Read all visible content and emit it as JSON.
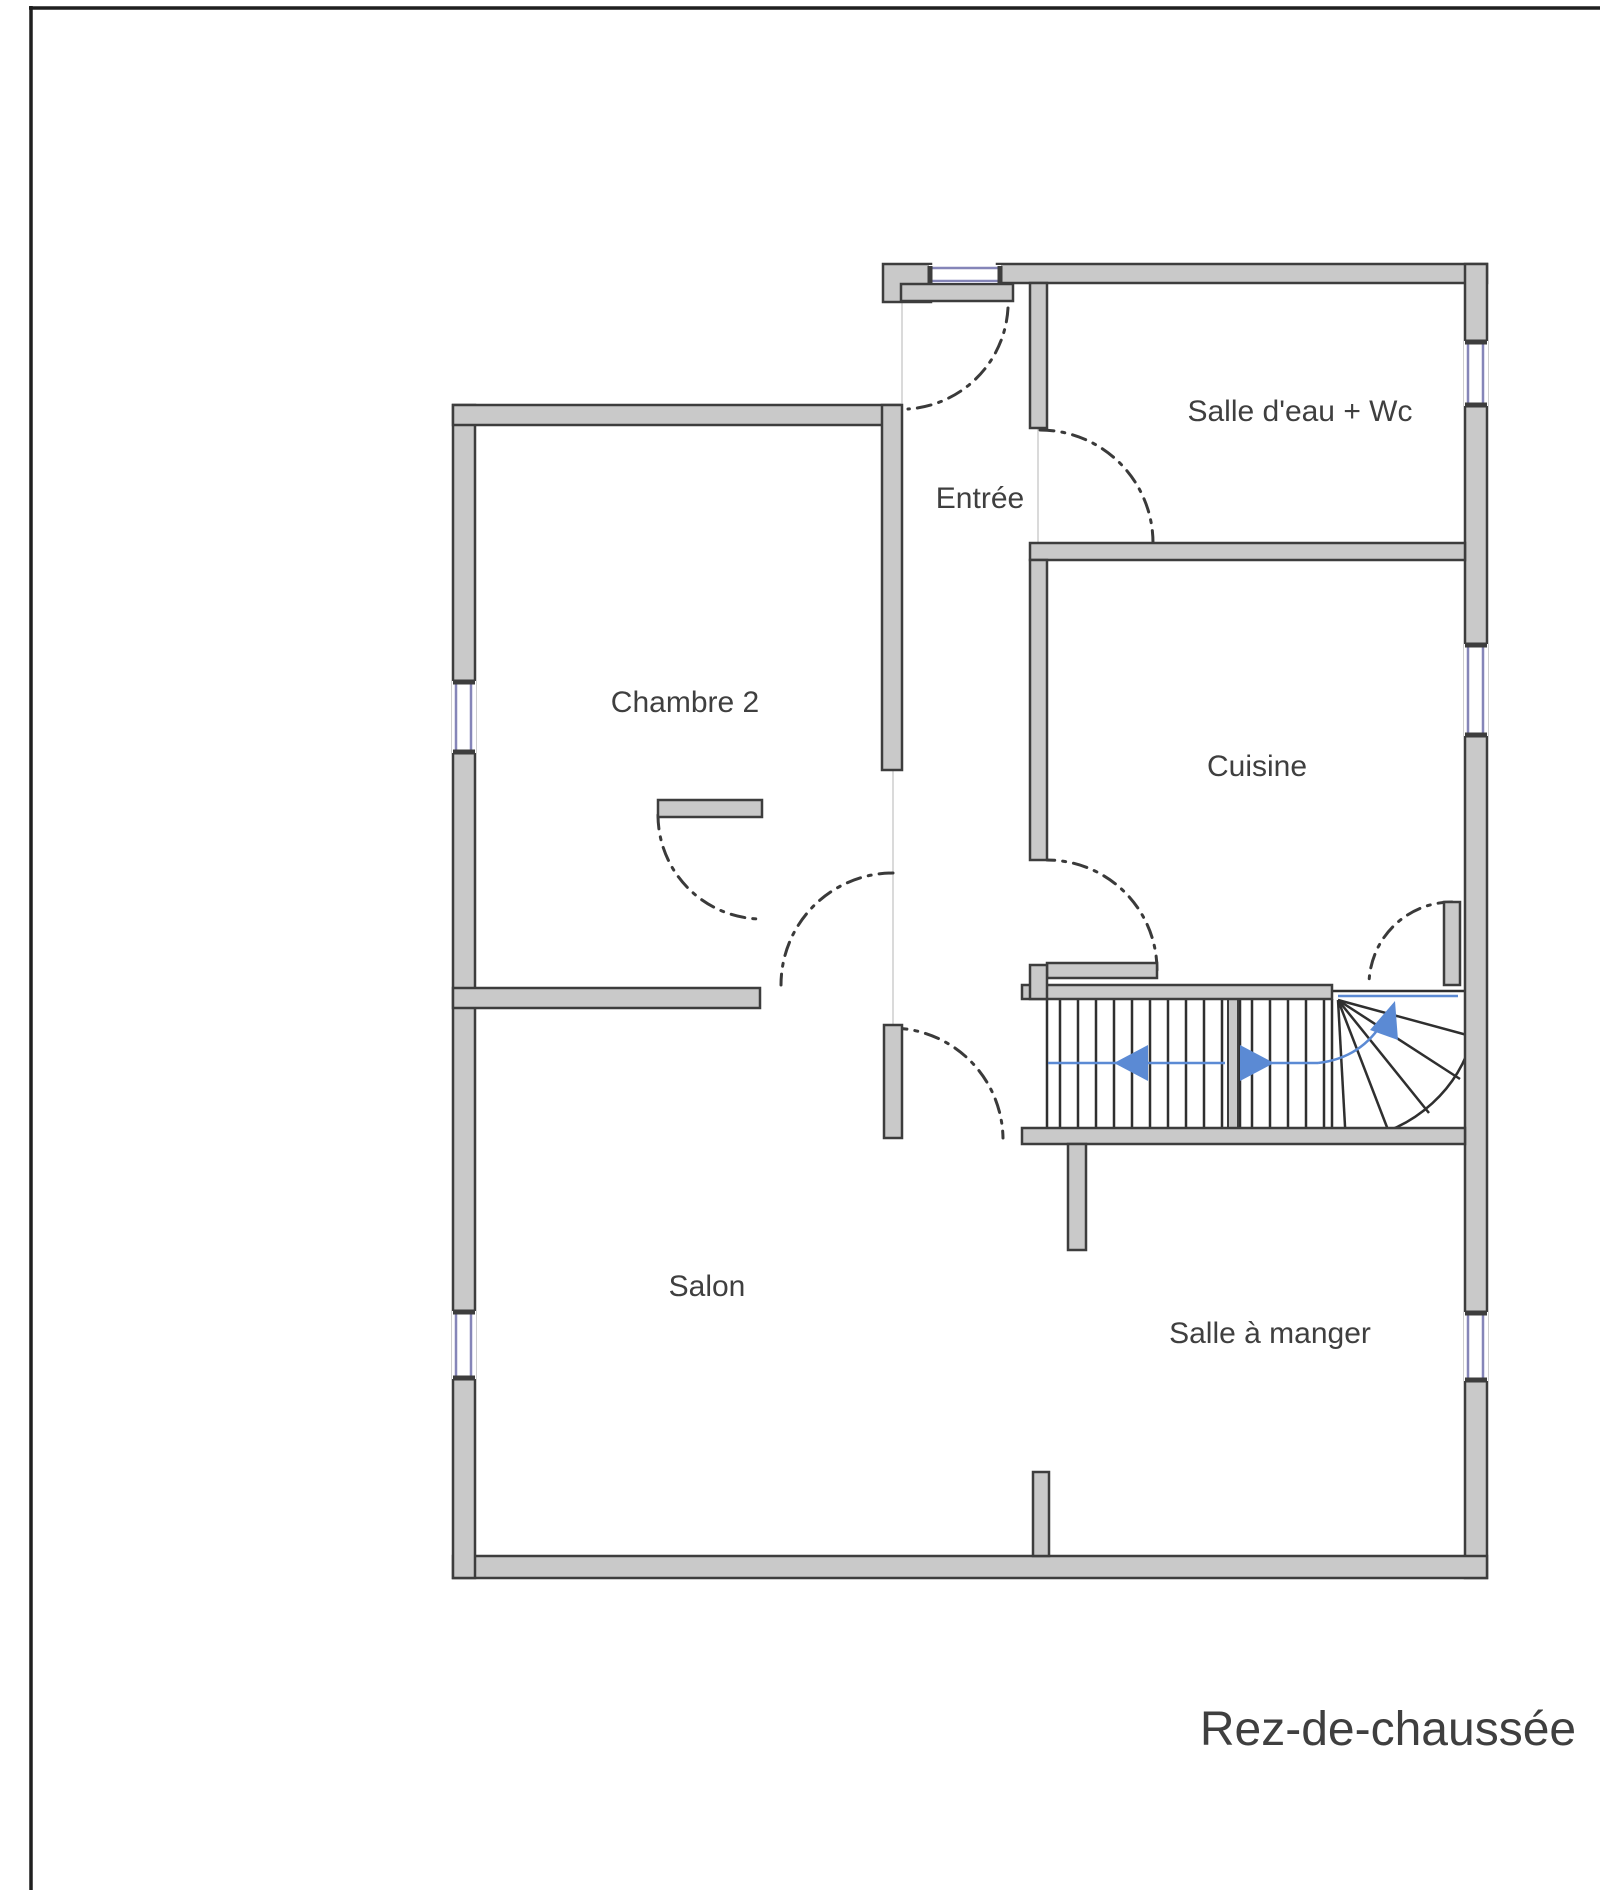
{
  "floor_plan": {
    "title": "Rez-de-chaussée",
    "rooms": [
      {
        "id": "entree",
        "label": "Entrée"
      },
      {
        "id": "salle-deau-wc",
        "label": "Salle d'eau + Wc"
      },
      {
        "id": "chambre-2",
        "label": "Chambre 2"
      },
      {
        "id": "cuisine",
        "label": "Cuisine"
      },
      {
        "id": "salon",
        "label": "Salon"
      },
      {
        "id": "salle-a-manger",
        "label": "Salle à manger"
      }
    ],
    "colors": {
      "wall_fill": "#c9c9c9",
      "wall_stroke": "#3d3d3d",
      "window_frame": "#8585b8",
      "stair_arrow": "#5b8ad4",
      "stair_line": "#2f2f2f",
      "door_arc": "#3a3a3a",
      "guide_line": "#dadada",
      "page_frame": "#1f1f1f",
      "label_text": "#3f3f3f"
    }
  }
}
